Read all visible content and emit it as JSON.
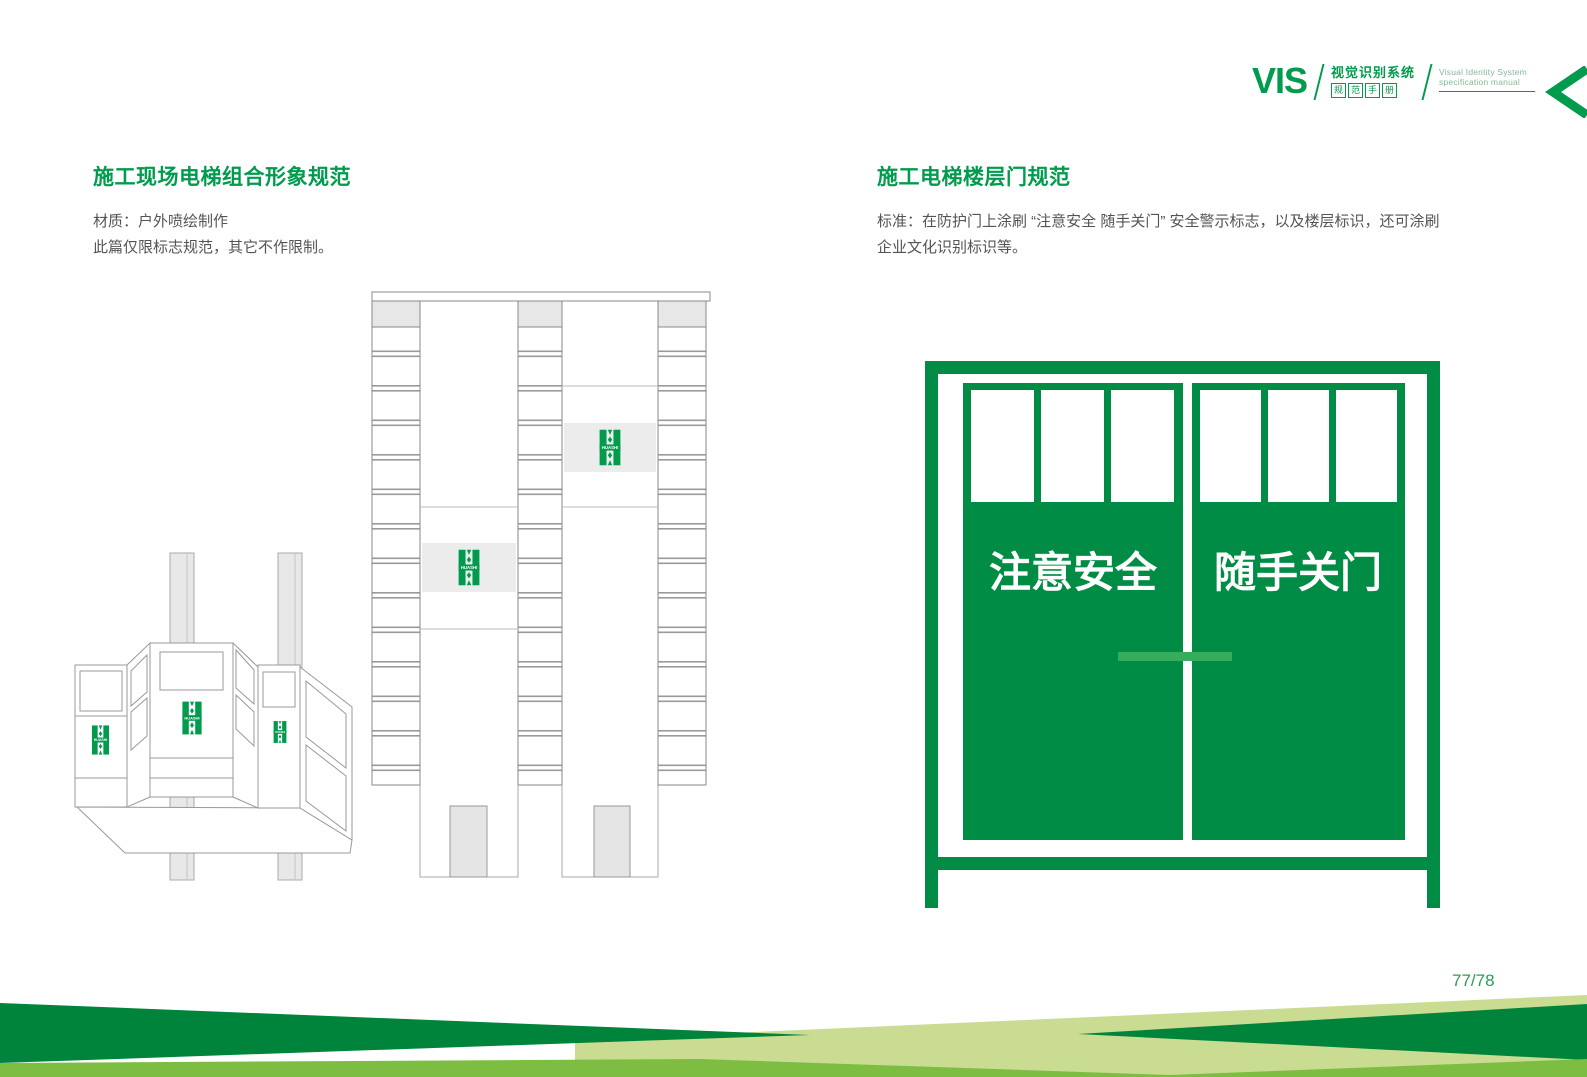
{
  "header": {
    "vis": "VIS",
    "cn_line1": "视觉识别系统",
    "cn_line2": [
      "规",
      "范",
      "手",
      "册"
    ],
    "en_line1": "Visual Identity System",
    "en_line2": "specification manual"
  },
  "left_section": {
    "title": "施工现场电梯组合形象规范",
    "body_line1": "材质：户外喷绘制作",
    "body_line2": "此篇仅限标志规范，其它不作限制。"
  },
  "right_section": {
    "title": "施工电梯楼层门规范",
    "body_line1": "标准：在防护门上涂刷 “注意安全 随手关门”  安全警示标志，以及楼层标识，还可涂刷",
    "body_line2": "企业文化识别标识等。"
  },
  "door_sign": {
    "left_text": "注意安全",
    "right_text": "随手关门"
  },
  "logo_text": "HUASHI",
  "page_number": "77/78",
  "colors": {
    "brand_green": "#009B4C",
    "door_green": "#008C44",
    "handle_green": "#35AD5C",
    "footer_dark_green": "#00843C",
    "footer_medium_green": "#7DBE42",
    "footer_pale_green": "#C9DC92",
    "body_text_gray": "#545454",
    "diagram_line_gray": "#999999",
    "diagram_fill_gray": "#E7E7E7"
  }
}
